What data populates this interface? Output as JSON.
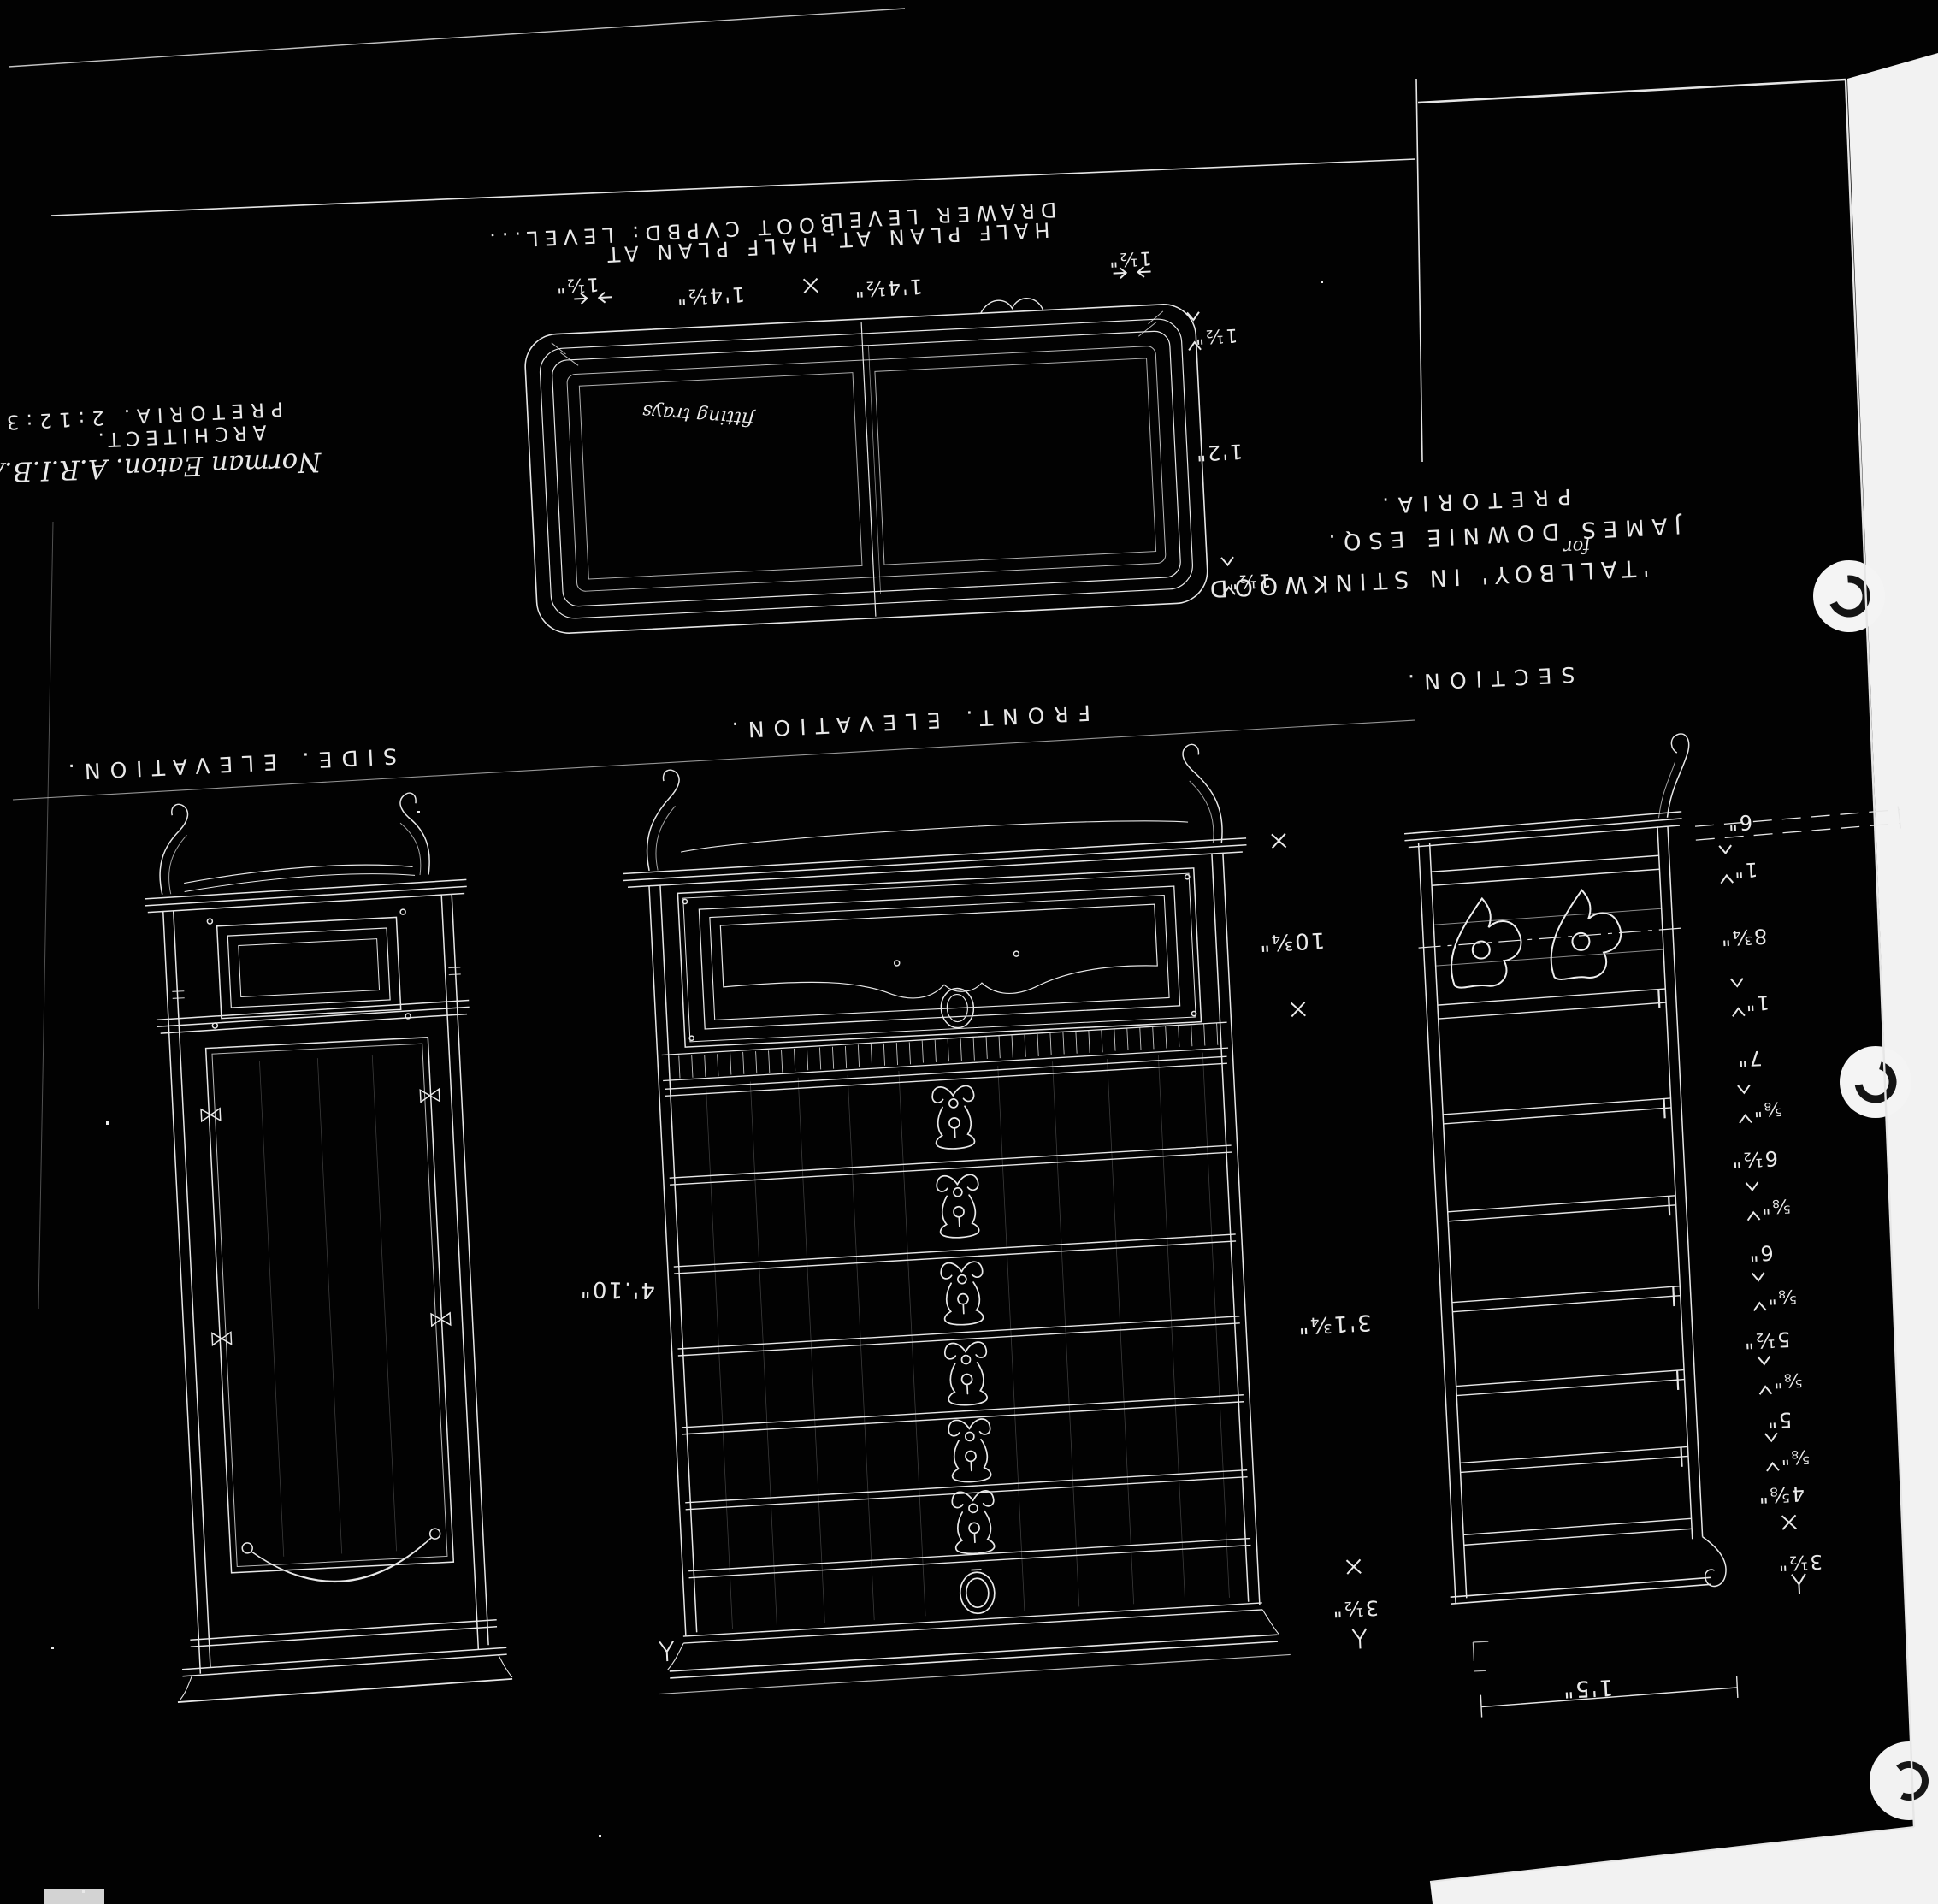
{
  "sheet": {
    "media": "photostat-negative",
    "ink_color": "#e9e9e9",
    "paper_color": "#020202",
    "margin_color": "#f2f2f2"
  },
  "labels": {
    "half_plan_left_l1": "HALF PLAN AT",
    "half_plan_left_l2": "BOOT CVPBD: LEVEL...",
    "half_plan_right_l1": "HALF PLAN AT.",
    "half_plan_right_l2": "DRAWER LEVEL.",
    "plan_note": "fitting trays",
    "side_elevation": "SIDE. ELEVATION.",
    "front_elevation": "FRONT. ELEVATION.",
    "section": "SECTION.",
    "title_l1": "'TALLBOY' IN STINKWOOD",
    "title_l2": "for",
    "title_l3": "JAMES DOWNIE ESQ.",
    "title_l4": "PRETORIA.",
    "arch_l1": "Norman Eaton. A.R.I.B.A.",
    "arch_l2": "ARCHITECT.",
    "arch_l3": "PRETORIA.  2:12:33."
  },
  "dims": {
    "plan": {
      "gap_left": "1½\"",
      "width_left": "1'4½\"",
      "width_right": "1'4½\"",
      "corner": "1½\"",
      "side_top": "1½\"",
      "depth": "1'2\"",
      "side_bottom": "1½\""
    },
    "front_height": "4'.10\"",
    "door_height": "10¾\"",
    "drawer_stack": "3'1¾\"",
    "base_height": "3½\"",
    "section_depth": "1'5\"",
    "section_heights": [
      "6\"",
      "1\"",
      "8¾\"",
      "1\"",
      "7\"",
      "⅝\"",
      "6½\"",
      "⅝\"",
      "6\"",
      "⅝\"",
      "5½\"",
      "⅝\"",
      "5\"",
      "⅝\"",
      "4⅝\"",
      "3½\""
    ]
  }
}
